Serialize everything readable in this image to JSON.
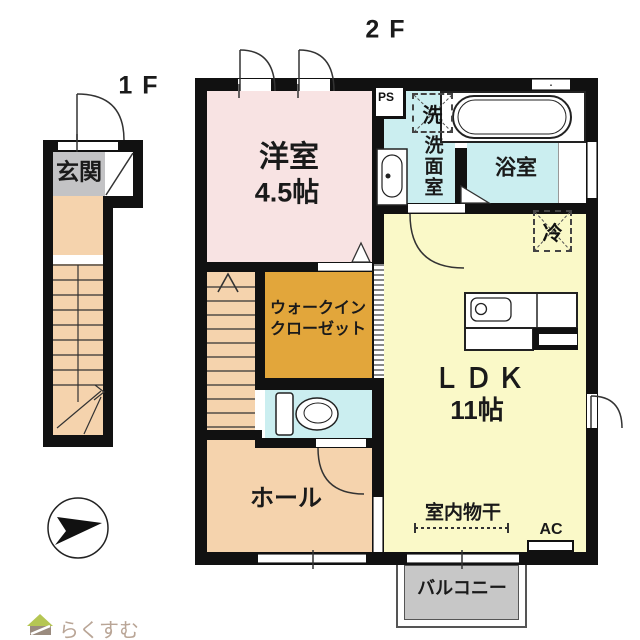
{
  "labels": {
    "floor1": "1F",
    "floor2": "2F"
  },
  "floor1": {
    "genkan": "玄関"
  },
  "floor2": {
    "yoshitsu_name": "洋室",
    "yoshitsu_size": "4.5帖",
    "ps": "PS",
    "washer_mark": "洗",
    "senmen": "洗面室",
    "bath": "浴室",
    "fridge_mark": "冷",
    "wic_line1": "ウォークイン",
    "wic_line2": "クローゼット",
    "ldk_name": "ＬＤＫ",
    "ldk_size": "11帖",
    "hall": "ホール",
    "monohoshi": "室内物干",
    "ac": "AC",
    "balcony": "バルコニー"
  },
  "logo": {
    "text": "らくすむ"
  },
  "colors": {
    "wall": "#111111",
    "room_pink": "#F8E3E3",
    "room_peach": "#F5D3AD",
    "room_yellow": "#FAF9C8",
    "room_cyan": "#CBEEF0",
    "room_gold": "#E2A63B",
    "genkan_gray": "#C3C3C5",
    "balcony_gray": "#C7C7C7",
    "white": "#FFFFFF",
    "logo_green": "#B5C653",
    "logo_brown": "#9A8B7E",
    "logo_text": "#B9A596"
  }
}
